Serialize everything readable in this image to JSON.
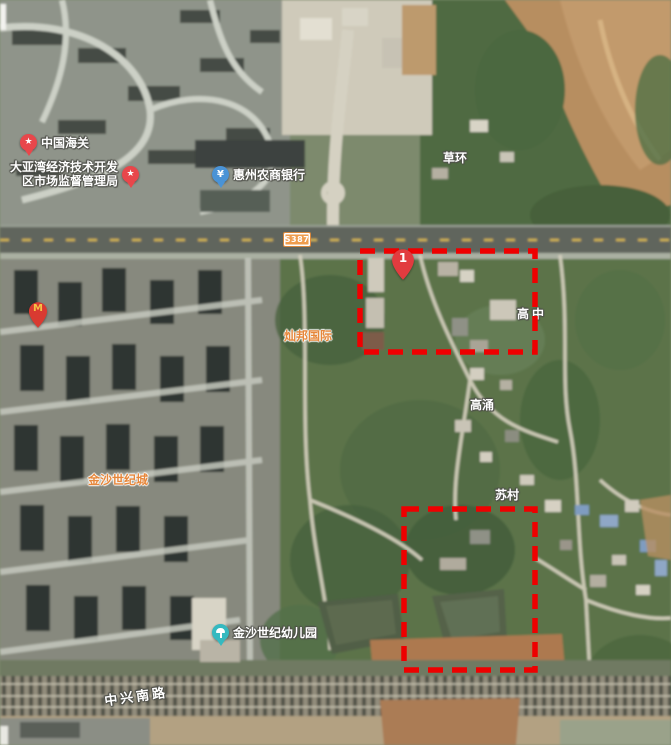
{
  "map": {
    "marker1": "1",
    "road_badge": "S387",
    "road_name": "中兴南路",
    "places": {
      "caohuan": "草环",
      "gaozhong": "高中",
      "gaoyong": "高涌",
      "sucun": "苏村"
    },
    "complexes": {
      "canbang": "灿邦国际",
      "jinsha": "金沙世纪城"
    },
    "pois": {
      "customs": {
        "label": "中国海关"
      },
      "bureau": {
        "line1": "大亚湾经济技术开发",
        "line2": "区市场监督管理局"
      },
      "bank": {
        "label": "惠州农商银行",
        "symbol": "¥"
      },
      "kindergarten": {
        "label": "金沙世纪幼儿园"
      },
      "mcdonalds": {
        "symbol": "M"
      }
    },
    "icons": {
      "star": "★"
    },
    "colors": {
      "annotation_red": "#ee0000",
      "pin_red": "#e8474b",
      "pin_blue": "#4a93d6",
      "pin_teal": "#35b9c0",
      "label_orange": "#e6873b",
      "badge_orange": "#ef9d4e"
    }
  }
}
